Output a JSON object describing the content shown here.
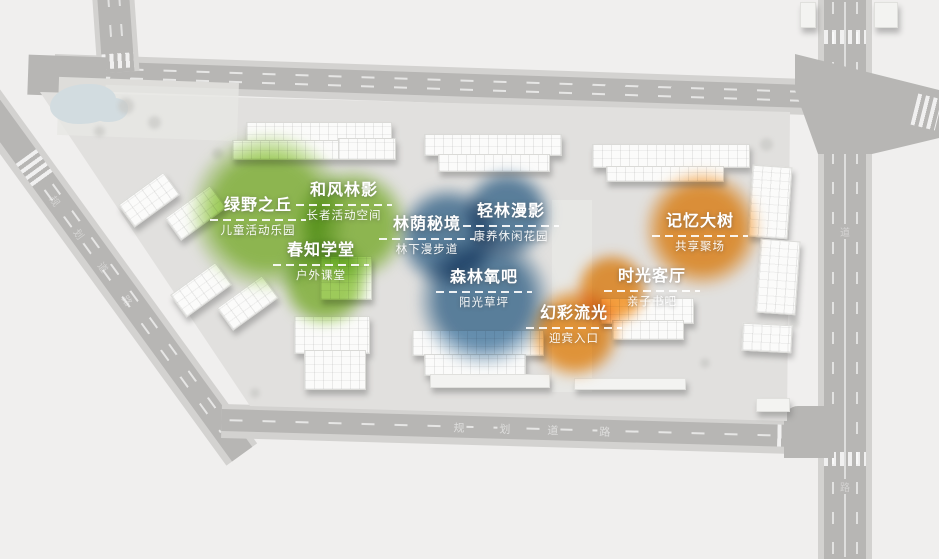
{
  "plan": {
    "zones": [
      {
        "title": "绿野之丘",
        "subtitle": "儿童活动乐园",
        "theme": "green"
      },
      {
        "title": "和风林影",
        "subtitle": "长者活动空间",
        "theme": "green"
      },
      {
        "title": "春知学堂",
        "subtitle": "户外课堂",
        "theme": "green"
      },
      {
        "title": "林荫秘境",
        "subtitle": "林下漫步道",
        "theme": "blue"
      },
      {
        "title": "轻林漫影",
        "subtitle": "康养休闲花园",
        "theme": "blue"
      },
      {
        "title": "森林氧吧",
        "subtitle": "阳光草坪",
        "theme": "blue"
      },
      {
        "title": "记忆大树",
        "subtitle": "共享聚场",
        "theme": "orange"
      },
      {
        "title": "时光客厅",
        "subtitle": "亲子书吧",
        "theme": "orange"
      },
      {
        "title": "幻彩流光",
        "subtitle": "迎宾入口",
        "theme": "orange"
      }
    ],
    "road_labels": {
      "bottom": [
        "规",
        "划",
        "道",
        "路"
      ],
      "left": [
        "规",
        "划",
        "道",
        "路"
      ],
      "right": [
        "道",
        "路"
      ]
    },
    "colors": {
      "green": "#8fc63f",
      "blue": "#4a7ba3",
      "orange": "#f6921e",
      "road": "#b7b6b4",
      "sidewalk": "#d3d2d0",
      "ground": "#e1e0de",
      "canvas": "#f0efee",
      "building": "#fbfbfa",
      "pond": "#d2dce0",
      "label": "#ffffff"
    }
  }
}
